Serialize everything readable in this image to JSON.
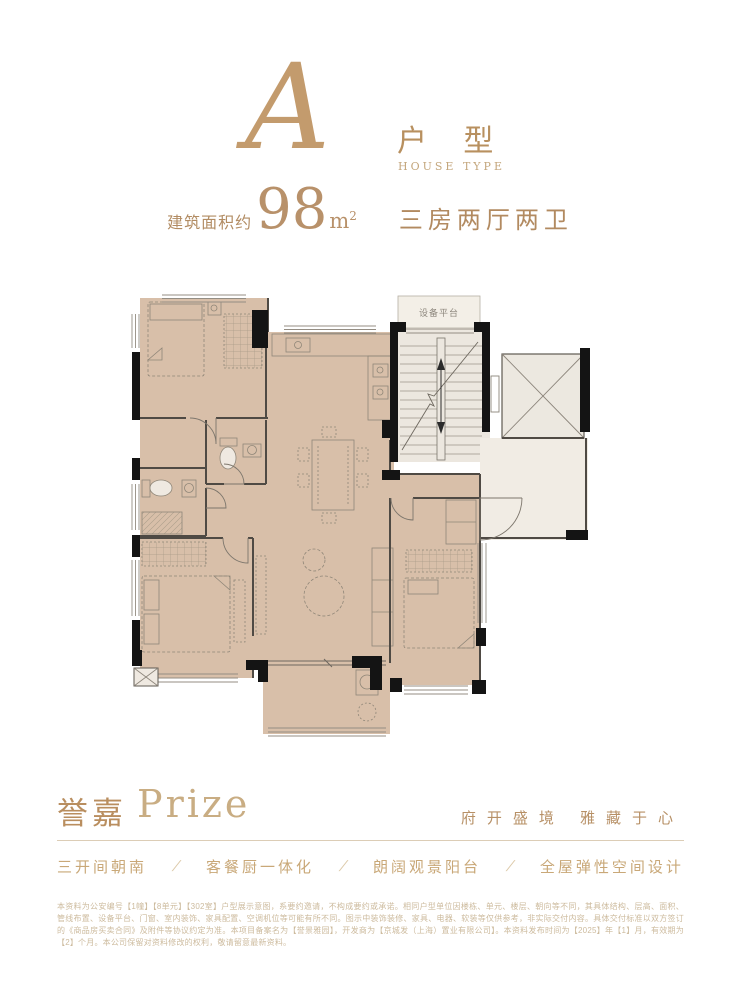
{
  "colors": {
    "accent_gold": "#b8905f",
    "floor_beige": "#d8bfa9",
    "core_light": "#ece7df",
    "wall_black": "#141414"
  },
  "header": {
    "type_letter": "A",
    "type_label_cn": "户 型",
    "type_label_en": "HOUSE TYPE",
    "area_prefix": "建筑面积约",
    "area_value": "98",
    "area_unit_base": "m",
    "area_unit_exp": "2",
    "layout_desc": "三房两厅两卫"
  },
  "floorplan": {
    "labels": {
      "equipment_platform": "设备平台"
    }
  },
  "footer": {
    "brand_cn": "誉嘉",
    "brand_en": "Prize",
    "slogan": "府开盛境  雅藏于心",
    "separator": "/",
    "features": [
      "三开间朝南",
      "客餐厨一体化",
      "朗阔观景阳台",
      "全屋弹性空间设计"
    ],
    "disclaimer": "本资料为公安编号【1幢】【8单元】【302室】户型展示意图，系要约邀请，不构成要约或承诺。相同户型单位因楼栋、单元、楼层、朝向等不同，其具体结构、层高、面积、管线布置、设备平台、门窗、室内装饰、家具配置、空调机位等可能有所不同。图示中装饰装修、家具、电器、软装等仅供参考，非实际交付内容。具体交付标准以双方签订的《商品房买卖合同》及附件等协议约定为准。本项目备案名为【誉景雅园】，开发商为【京城发（上海）置业有限公司】。本资料发布时间为【2025】年【1】月，有效期为【2】个月。本公司保留对资料修改的权利，敬请留意最新资料。"
  }
}
